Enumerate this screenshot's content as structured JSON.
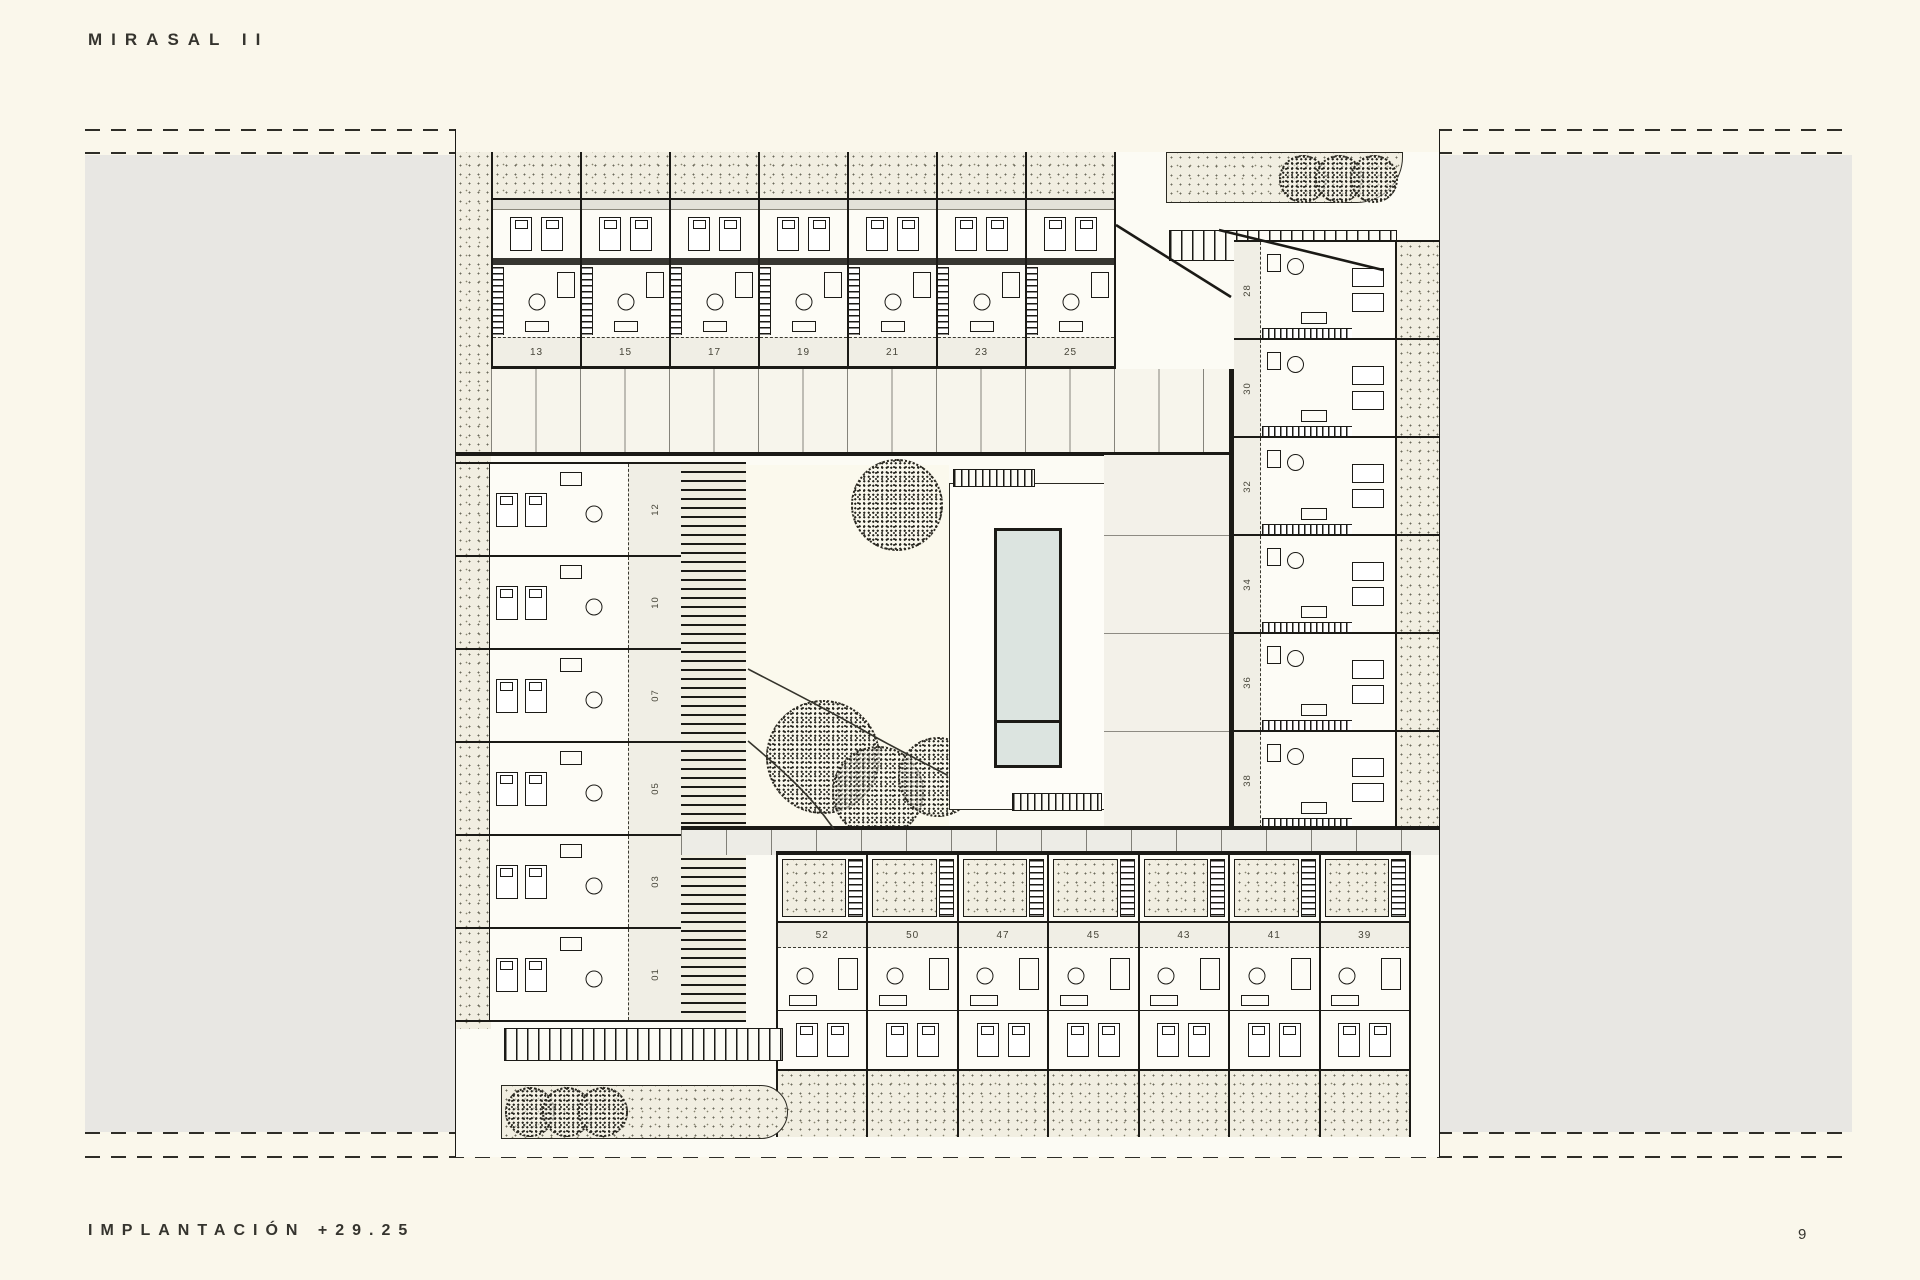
{
  "title": "MIRASAL II",
  "footer": {
    "label": "IMPLANTACIÓN +29.25",
    "page_number": "9"
  },
  "site_plan": {
    "drawing_name": "site plan with housing units around central pool courtyard",
    "unit_rows": {
      "top": [
        "13",
        "15",
        "17",
        "19",
        "21",
        "23",
        "25"
      ],
      "right_column": [
        "28",
        "30",
        "32",
        "34",
        "36",
        "38"
      ],
      "left_column": [
        "12",
        "10",
        "07",
        "05",
        "03",
        "01"
      ],
      "bottom": [
        "52",
        "50",
        "47",
        "45",
        "43",
        "41",
        "39"
      ]
    }
  },
  "colors": {
    "paper": "#FAF7EB",
    "band": "#E8E7E3",
    "planbg": "#FCFBF4",
    "stip": "#F1EEE1",
    "ink": "#1B1A16",
    "water": "#DCE4E0",
    "label": "#F0EEE5",
    "muted": "#474539"
  }
}
